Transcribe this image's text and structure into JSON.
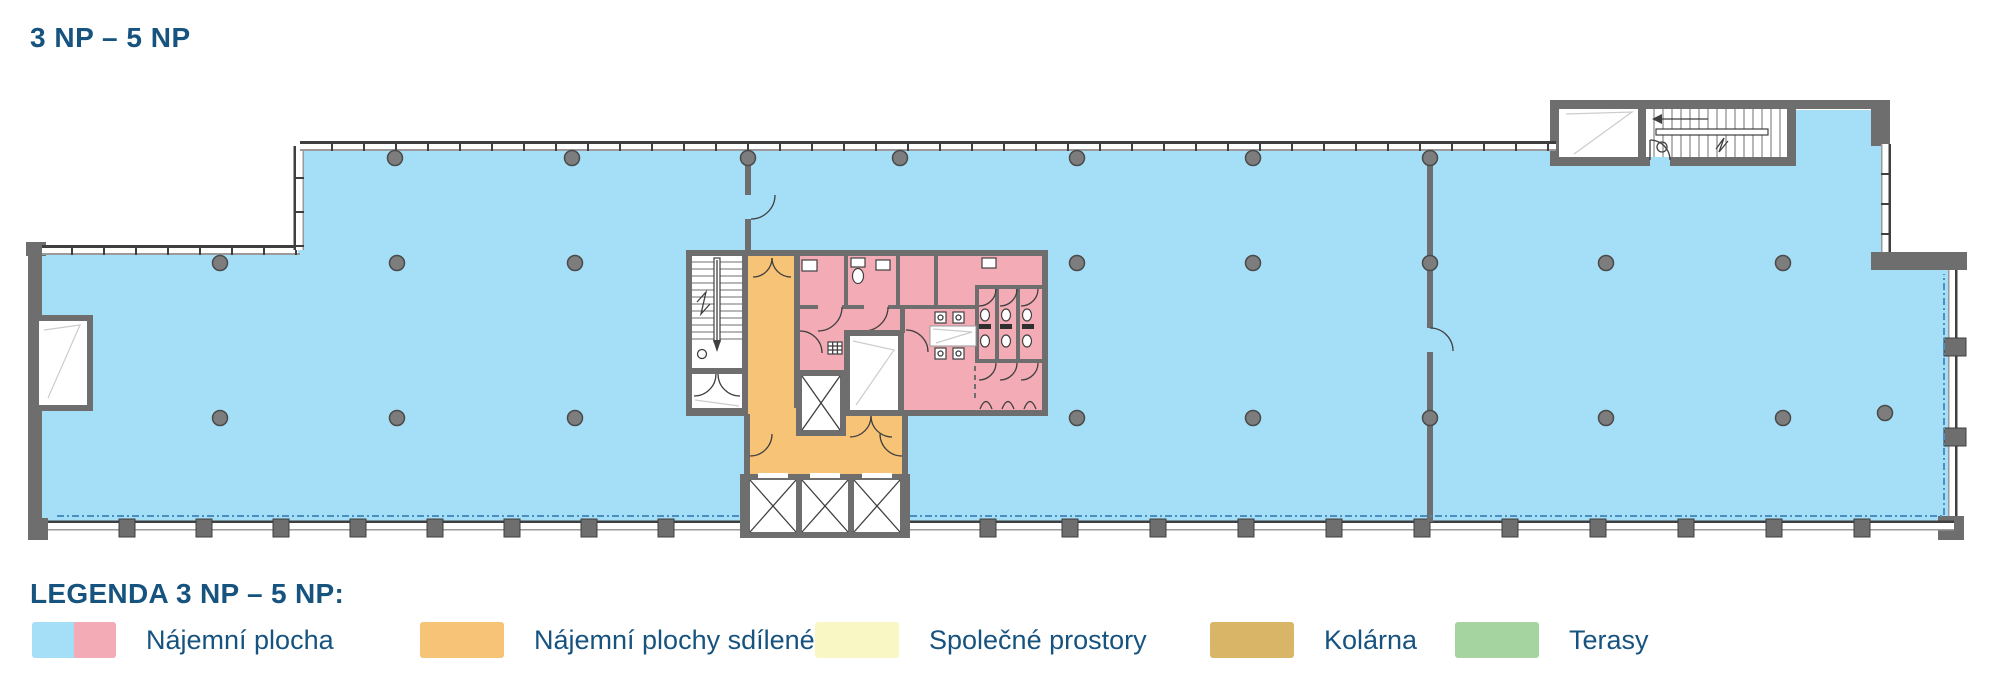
{
  "title": "3 NP – 5 NP",
  "legend": {
    "heading": "LEGENDA 3 NP – 5 NP:",
    "items": [
      {
        "label": "Nájemní plocha",
        "colors": [
          "#a5def7",
          "#f3acb6"
        ]
      },
      {
        "label": "Nájemní plochy sdílené",
        "colors": [
          "#f7c376"
        ]
      },
      {
        "label": "Společné prostory",
        "colors": [
          "#f9f8c5"
        ]
      },
      {
        "label": "Kolárna",
        "colors": [
          "#d9b567"
        ]
      },
      {
        "label": "Terasy",
        "colors": [
          "#a6d4a0"
        ]
      }
    ]
  },
  "palette": {
    "tenant_blue": "#a5def7",
    "tenant_pink": "#f3acb6",
    "shared_orange": "#f7c376",
    "common_yellow": "#f9f8c5",
    "bike_tan": "#d9b567",
    "terrace_green": "#a6d4a0",
    "wall": "#6e6e6e",
    "wall_dark": "#3f3f3f",
    "wall_light": "#9a9a9a",
    "column": "#7d7d7d",
    "column_stroke": "#4a4a4a",
    "text_blue": "#17537f",
    "dashed": "#4a8fc0"
  }
}
